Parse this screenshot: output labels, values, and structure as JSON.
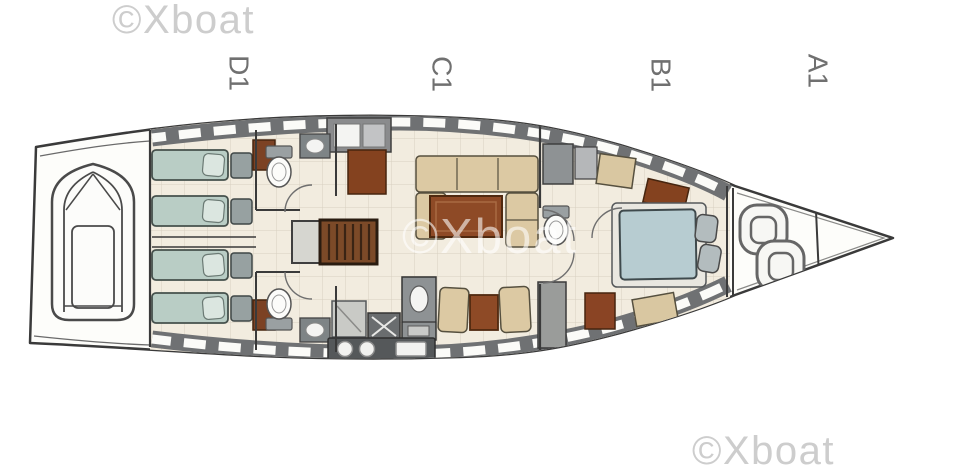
{
  "canvas": {
    "width": 960,
    "height": 474,
    "background": "#ffffff"
  },
  "watermark": {
    "text": "©Xboat",
    "corner_color": "#cdcdcd",
    "center_style": "semi-transparent white"
  },
  "sections": [
    {
      "label": "D1"
    },
    {
      "label": "C1"
    },
    {
      "label": "B1"
    },
    {
      "label": "A1"
    }
  ],
  "label_color": "#707070",
  "plan_colors": {
    "outline": "#3a3a3a",
    "hull_fill": "#fdfdfa",
    "floor": "#f2ecdf",
    "grid_line": "#d8d0c0",
    "deck_band": "#6f7173",
    "berth_aft": "#b9cdc5",
    "berth_double": "#b7ccd1",
    "wood_brown": "#8a4424",
    "settee_tan": "#dcc9a3",
    "counter_dark": "#55585a",
    "fixture_gray": "#8e9294"
  }
}
